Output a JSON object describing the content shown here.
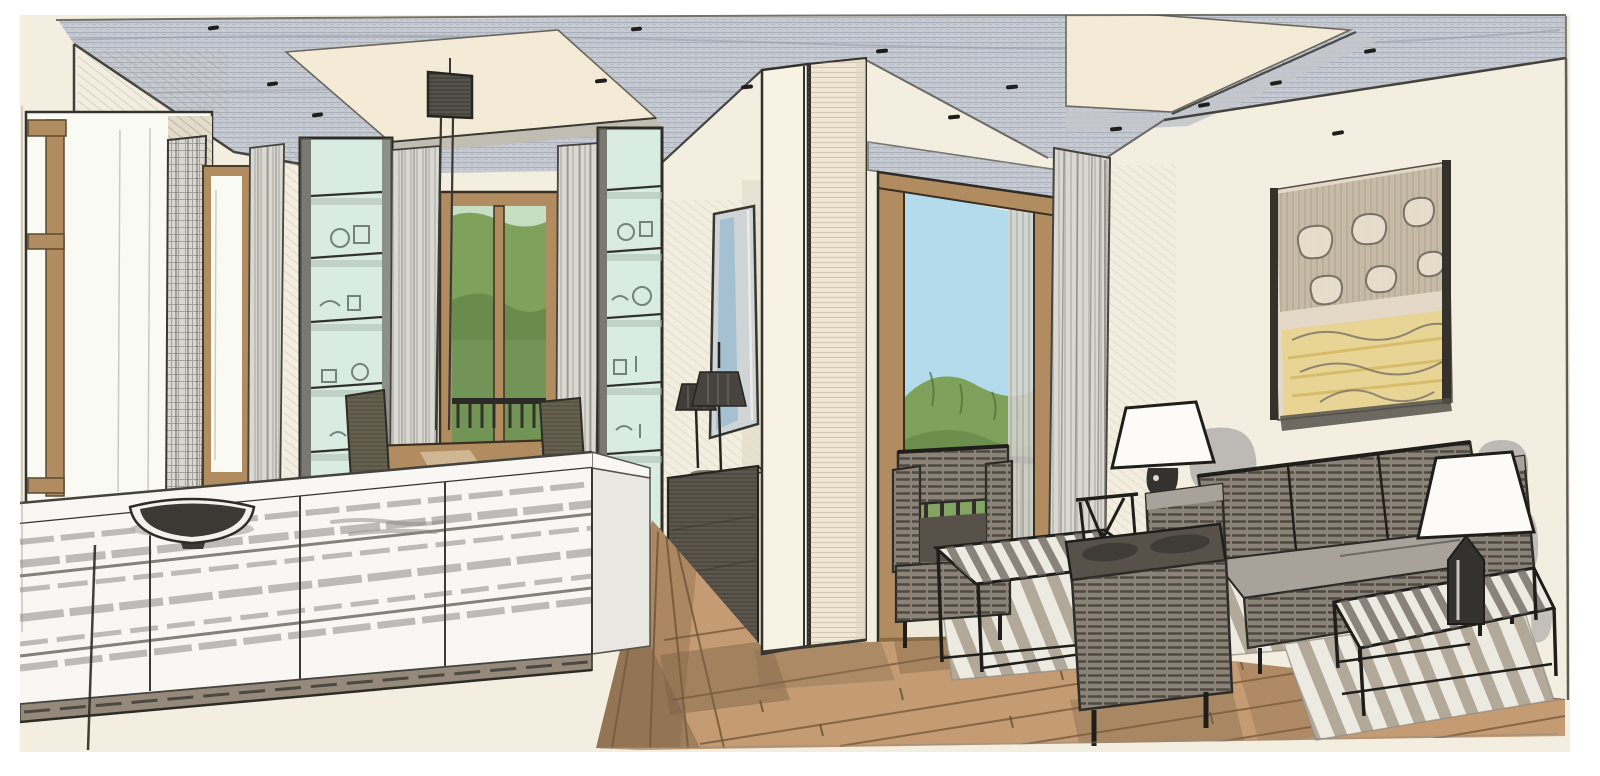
{
  "meta": {
    "title": "Hand-drawn interior design sketch of an open-plan living and dining room with kitchen island, balcony doors and green hillside view",
    "medium": "pencil and marker architectural perspective rendering",
    "canvas_width": 1600,
    "canvas_height": 776
  },
  "palette": {
    "paper": "#ffffff",
    "wall": "#f3eedf",
    "wall-shade": "#e3dccb",
    "ceiling": "#c8ccd4",
    "recess": "#f4ebd7",
    "recess-band": "#c1bdb2",
    "sky": "#b4dbec",
    "green": "#7ea25c",
    "green-dark": "#5d7f44",
    "green-light": "#9cbb7d",
    "mint": "#d9ece2",
    "wood": "#b18c60",
    "wood-dark": "#8a6b44",
    "floor": "#c49b72",
    "floor-line": "#6e5335",
    "ink": "#2b2a26",
    "pencil": "#8f8c84",
    "island": "#f8f7f3",
    "island-side": "#e9e7e1",
    "plinth": "#94897a",
    "curtain": "#dad8d2",
    "sofa": "#8b8278",
    "sofa-dark": "#57514a",
    "seat": "#a9a29a",
    "olive": "#66614f",
    "sideboard": "#5c564c",
    "shade-white": "#fcfbf7",
    "shadow": "#b7b4b0",
    "art-tan": "#b1a28c",
    "art-yellow": "#e9d388",
    "rug": "#edeae2",
    "rug-stripe": "#a4988a",
    "glass-white": "#fafaf5",
    "metal-dark": "#34322e"
  },
  "scene": {
    "elements": [
      {
        "name": "ceiling",
        "description": "grey pencil-hatched ceiling with two cream recessed light coves and black downlight dots"
      },
      {
        "name": "downlights",
        "description": "small black dash marks for recessed spotlights"
      },
      {
        "name": "window-left-outer",
        "description": "tall wood-framed window in deep reveal at far left"
      },
      {
        "name": "window-left-inner",
        "description": "narrow second wood-framed window"
      },
      {
        "name": "curtain-plaid",
        "description": "floor length checked curtain panel"
      },
      {
        "name": "glass-cabinet-left",
        "description": "tall glass display cabinet with pale mint shelves"
      },
      {
        "name": "glass-cabinet-right",
        "description": "second tall glass display cabinet flanking dining window"
      },
      {
        "name": "dining-window",
        "description": "wood framed window with green trees and balcony railing"
      },
      {
        "name": "dining-table",
        "description": "rectangular wooden dining table"
      },
      {
        "name": "dining-chairs",
        "description": "dark upholstered dining chairs"
      },
      {
        "name": "pendant-light",
        "description": "box pendant luminaire on two drop rods over dining table"
      },
      {
        "name": "kitchen-island",
        "description": "long white kitchen island with banded front and taupe plinth"
      },
      {
        "name": "island-bowl",
        "description": "wide dark bowl on the countertop"
      },
      {
        "name": "wall-mirror",
        "description": "tall narrow mirror artwork with blue reflection streak"
      },
      {
        "name": "sideboard",
        "description": "dark grey chest of drawers with two small black lamps"
      },
      {
        "name": "column",
        "description": "large cream boarded structural column pair"
      },
      {
        "name": "balcony-door",
        "description": "tall wood framed glass door with sky and green hills"
      },
      {
        "name": "balcony-railing",
        "description": "black metal balustrade bars"
      },
      {
        "name": "curtain-living",
        "description": "grey curtain panel beside balcony door"
      },
      {
        "name": "artwork",
        "description": "large abstract drawing in tan, grey and yellow on right wall"
      },
      {
        "name": "wall-shadows",
        "description": "soft grey marker shadows cast by lamps on wall"
      },
      {
        "name": "sofa",
        "description": "three-seat striped grey-brown sofa"
      },
      {
        "name": "armchair-window",
        "description": "striped club armchair in front of balcony door"
      },
      {
        "name": "armchair-front",
        "description": "striped club armchair in the foreground"
      },
      {
        "name": "coffee-table-left",
        "description": "metal frame coffee table with slatted striped top"
      },
      {
        "name": "coffee-table-right",
        "description": "second metal frame coffee table holding a lamp"
      },
      {
        "name": "side-table",
        "description": "small black metal side table"
      },
      {
        "name": "table-lamp-left",
        "description": "white cone-shade table lamp behind sofa"
      },
      {
        "name": "table-lamp-right",
        "description": "white cone-shade table lamp with dark cylinder base"
      },
      {
        "name": "rugs",
        "description": "flat-woven rugs with diagonal grey stripes"
      },
      {
        "name": "floor",
        "description": "tan wooden plank floor drawn in perspective"
      }
    ]
  }
}
